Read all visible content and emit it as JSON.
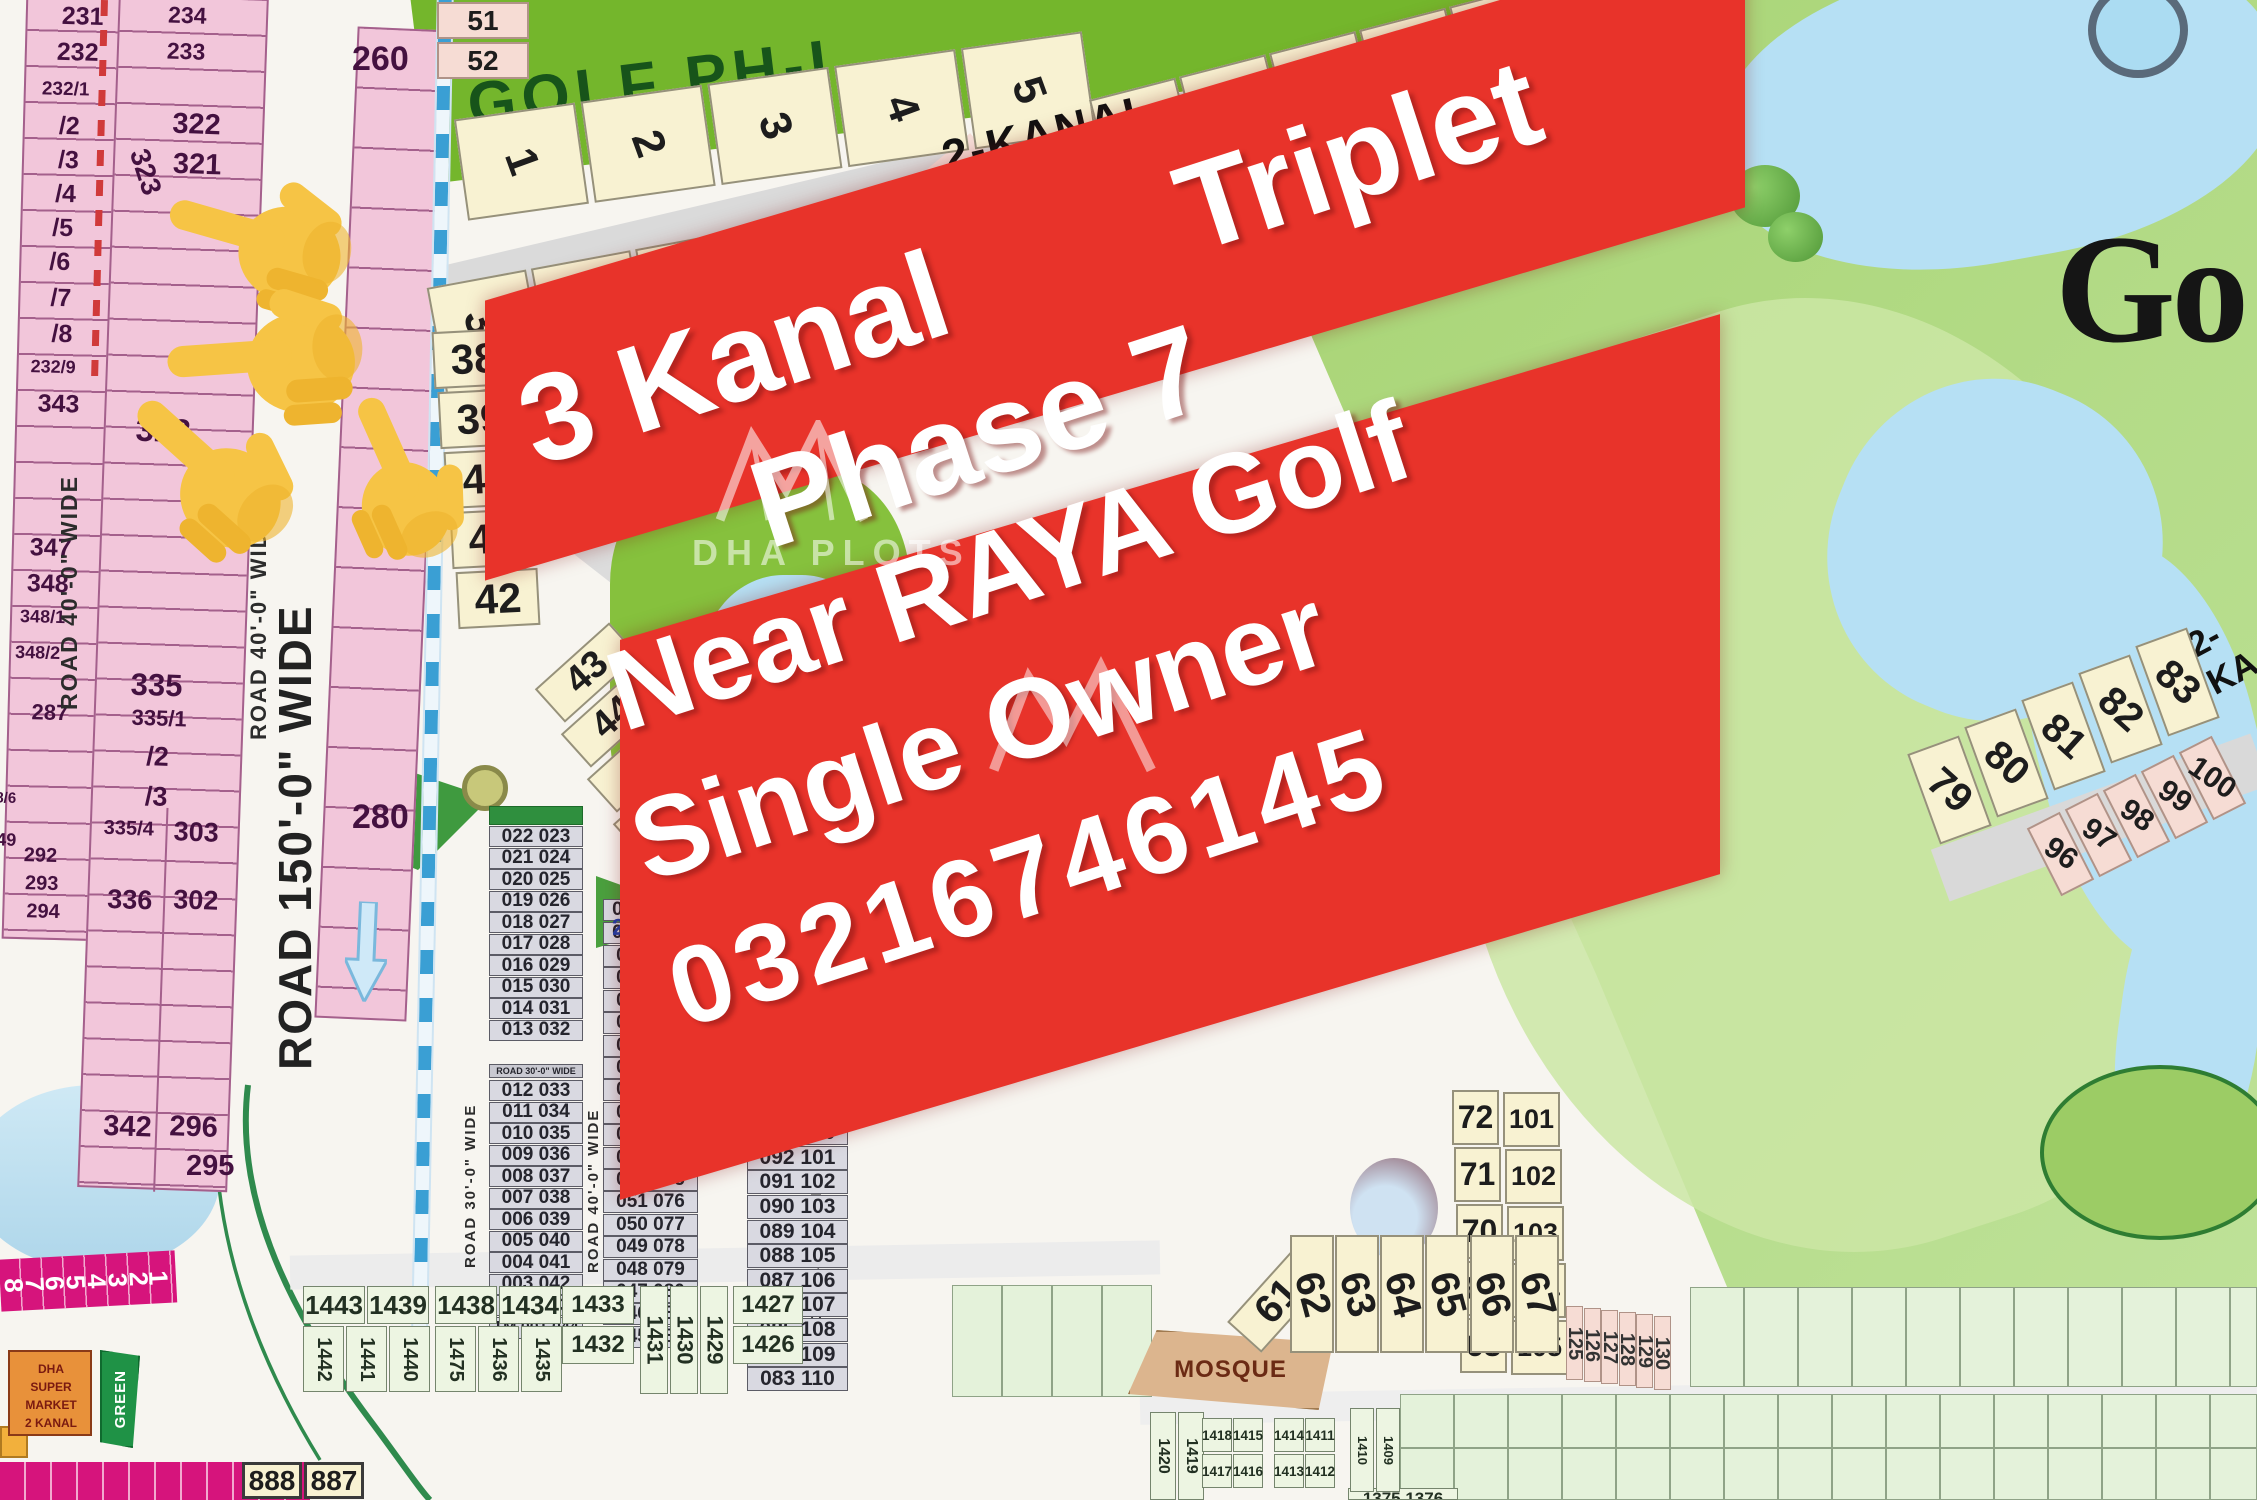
{
  "colors": {
    "banner_red": "#e8332a",
    "plot_pink": "#f2c6da",
    "plot_cream": "#f8f2d2",
    "golf_green": "#74b62c",
    "fairway": "#b5d98a",
    "lake": "#b6e0f4",
    "road_gray": "#dadada",
    "magenta": "#d6147c",
    "market_orange": "#e8913a",
    "green_box": "#1f9246",
    "road_blue": "#3a9fd4"
  },
  "banner": {
    "line1_left": "3 Kanal",
    "line1_right": "Triplet",
    "line2": "Phase 7",
    "line3": "Near RAYA Golf",
    "line4": "Single Owner",
    "line5": "03216746145"
  },
  "watermark": {
    "title": "DHA PLOTS"
  },
  "golf": {
    "phase_label": "GOLF PH-I",
    "kanal_label": "2-KANAL",
    "big_text": "Go",
    "kanal_short": "2-KA"
  },
  "top": {
    "row1": [
      "1",
      "2",
      "3",
      "4",
      "5"
    ],
    "row1b": [
      "10",
      "11",
      "12",
      "13",
      "14",
      "15"
    ],
    "row2": [
      "37",
      "36",
      "35",
      "34",
      "33",
      "32"
    ],
    "col38": [
      "38",
      "39",
      "40",
      "41",
      "42"
    ],
    "diag": [
      "43",
      "44",
      "45",
      "46"
    ],
    "side51": [
      "51",
      "52"
    ],
    "p59": "59",
    "p53": "53",
    "p60": "60",
    "p16": "16",
    "diag67": [
      "67",
      "66",
      "65"
    ]
  },
  "left": {
    "stripA": [
      "231",
      "232",
      "232/1",
      "/2",
      "/3",
      "/4",
      "/5",
      "/6",
      "/7",
      "/8",
      "232/9",
      "343",
      "347",
      "348",
      "348/1",
      "348/2",
      "287",
      "8/6",
      "49",
      "292",
      "293",
      "294"
    ],
    "stripB_top": [
      "234",
      "233",
      "322",
      "321"
    ],
    "rot323": "323",
    "stripB": [
      "328",
      "335",
      "335/1",
      "/2",
      "/3"
    ],
    "pairsL": [
      "335/4",
      "336",
      "342"
    ],
    "pairsR": [
      "303",
      "302",
      "296"
    ],
    "p295": "295",
    "p260": "260",
    "p280": "280",
    "road40": "ROAD 40'-0\" WIDE",
    "road150": "ROAD 150'-0\" WIDE"
  },
  "tables": {
    "t1a": [
      "022 023",
      "021 024",
      "020 025",
      "019 026",
      "018 027",
      "017 028",
      "016 029",
      "015 030",
      "014 031",
      "013 032"
    ],
    "t1_road": "ROAD 30'-0\" WIDE",
    "t1b": [
      "012 033",
      "011 034",
      "010 035",
      "009 036",
      "008 037",
      "007 038",
      "006 039",
      "005 040",
      "004 041",
      "003 042",
      "002 043"
    ],
    "t1c": "TM 001  044",
    "t2a": [
      "064",
      "063"
    ],
    "t2": [
      "062 065",
      "061 066",
      "060 067",
      "059 068",
      "058 069",
      "057 070",
      "056 071",
      "055 072",
      "054 073",
      "053 074",
      "052 075",
      "051 076",
      "050 077",
      "049 078",
      "048 079",
      "047 080",
      "046 081",
      "045 082"
    ],
    "t3a": "096",
    "t3": [
      "095 098",
      "094 099",
      "093 100",
      "092 101",
      "091 102",
      "090 103",
      "089 104",
      "088 105",
      "087 106",
      "086 107",
      "085 108",
      "084 109",
      "083 110"
    ],
    "road30": "ROAD 30'-0\" WIDE",
    "road40a": "ROAD 40'-0\" WIDE",
    "road40b": "ROAD 40'-0\" WIDE"
  },
  "right": {
    "row79": [
      "79",
      "80",
      "81",
      "82",
      "83"
    ],
    "row96": [
      "96",
      "97",
      "98",
      "99",
      "100"
    ],
    "colA": [
      "72",
      "71",
      "70",
      "69",
      "68"
    ],
    "colB": [
      "101",
      "102",
      "103",
      "104",
      "105"
    ],
    "row62": [
      "62",
      "63",
      "64",
      "65",
      "66",
      "67"
    ],
    "p61": "61",
    "col125": [
      "125",
      "126",
      "127",
      "128",
      "129",
      "130"
    ]
  },
  "bottom": {
    "kanal_label": "2-KANAL",
    "mosque_label": "MOSQUE",
    "mosque_area": "MOSQUE",
    "g1top": [
      "1443",
      "1439"
    ],
    "g1bot": [
      "1442",
      "1441",
      "1440"
    ],
    "g2top": [
      "1438",
      "1434"
    ],
    "g2bot": [
      "1475",
      "1436",
      "1435"
    ],
    "hA": [
      "1433",
      "1432"
    ],
    "rotB": [
      "1431",
      "1430",
      "1429"
    ],
    "hB": [
      "1427",
      "1426"
    ],
    "rotC": [
      "1420",
      "1419"
    ],
    "g4top": [
      "1418",
      "1415"
    ],
    "g4bot": [
      "1417",
      "1416"
    ],
    "g5top": [
      "1414",
      "1411"
    ],
    "g5bot": [
      "1413",
      "1412"
    ],
    "rotD": [
      "1410",
      "1409"
    ],
    "partial": "1375 1376",
    "market": [
      "DHA",
      "SUPER",
      "MARKET",
      "2 KANAL"
    ],
    "green_label": "GREEN",
    "p888": [
      "888",
      "887"
    ],
    "magenta": [
      "8",
      "7",
      "6",
      "5",
      "4",
      "3",
      "2",
      "1"
    ]
  }
}
